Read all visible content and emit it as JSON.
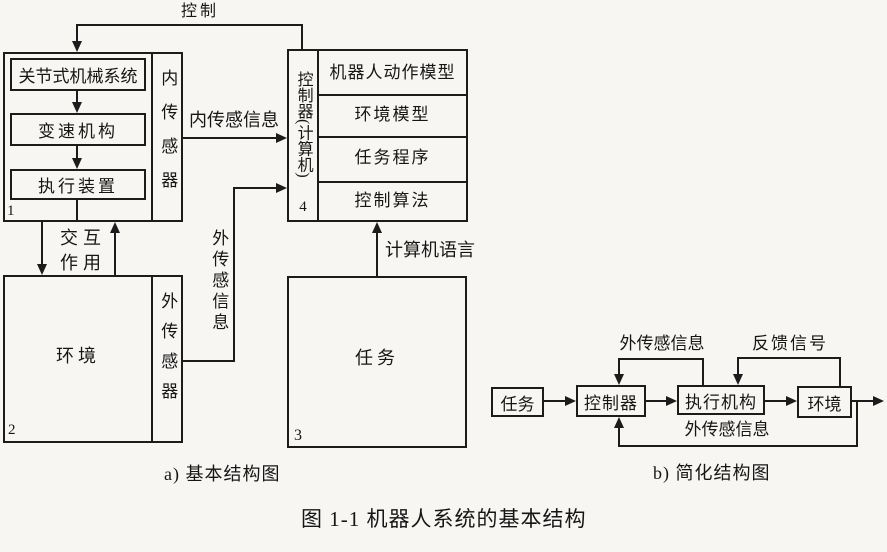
{
  "figure_caption": "图 1-1  机器人系统的基本结构",
  "part_a": {
    "caption": "a) 基本结构图",
    "mechanical_unit": {
      "number": "1",
      "blocks": [
        "关节式机械系统",
        "变速机构",
        "执行装置"
      ],
      "sensor_label": "内传感器"
    },
    "environment_unit": {
      "number": "2",
      "label": "环境",
      "sensor_label": "外传感器"
    },
    "task_unit": {
      "number": "3",
      "label": "任务"
    },
    "controller_unit": {
      "number": "4",
      "label": "控制器(计算机)",
      "rows": [
        "机器人动作模型",
        "环境模型",
        "任务程序",
        "控制算法"
      ]
    },
    "labels": {
      "control": "控制",
      "internal_sensing_info": "内传感信息",
      "interaction_line1": "交互",
      "interaction_line2": "作用",
      "external_sensing_info": "外传感信息",
      "computer_language": "计算机语言"
    }
  },
  "part_b": {
    "caption": "b) 简化结构图",
    "boxes": {
      "task": "任务",
      "controller": "控制器",
      "actuator": "执行机构",
      "environment": "环境"
    },
    "labels": {
      "external_sensing_top": "外传感信息",
      "feedback_signal": "反馈信号",
      "external_sensing_bottom": "外传感信息"
    }
  },
  "colors": {
    "paper": "#f7f6f3",
    "line": "#1c1c1c",
    "ink": "#161616"
  }
}
